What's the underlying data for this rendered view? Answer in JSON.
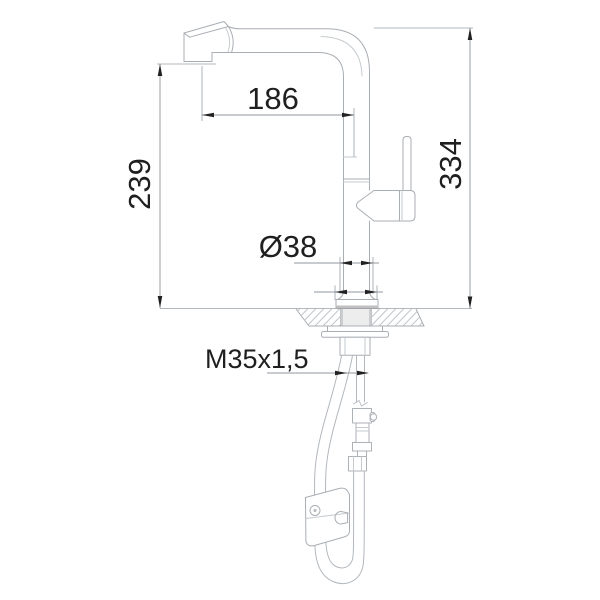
{
  "drawing": {
    "title": "faucet-installation-drawing",
    "subject": "Single-lever kitchen mixer tap with pull-out spray head, side elevation with mounting dimensions, countertop cross-section, supply hoses and counterweight",
    "labels": {
      "spout_reach": "186",
      "underspout_height": "239",
      "overall_height": "334",
      "base_diameter": "Ø38",
      "thread_size": "M35x1,5"
    },
    "colors": {
      "background": "#ffffff",
      "outline": "#a9aeb3",
      "detail": "#c6cbcf",
      "dimension_line": "#8f969c",
      "extension_line": "#9aa1a7",
      "arrow_and_text": "#1f1f1f",
      "hatch": "#b9bec3",
      "shank_fill": "#ededed"
    }
  }
}
